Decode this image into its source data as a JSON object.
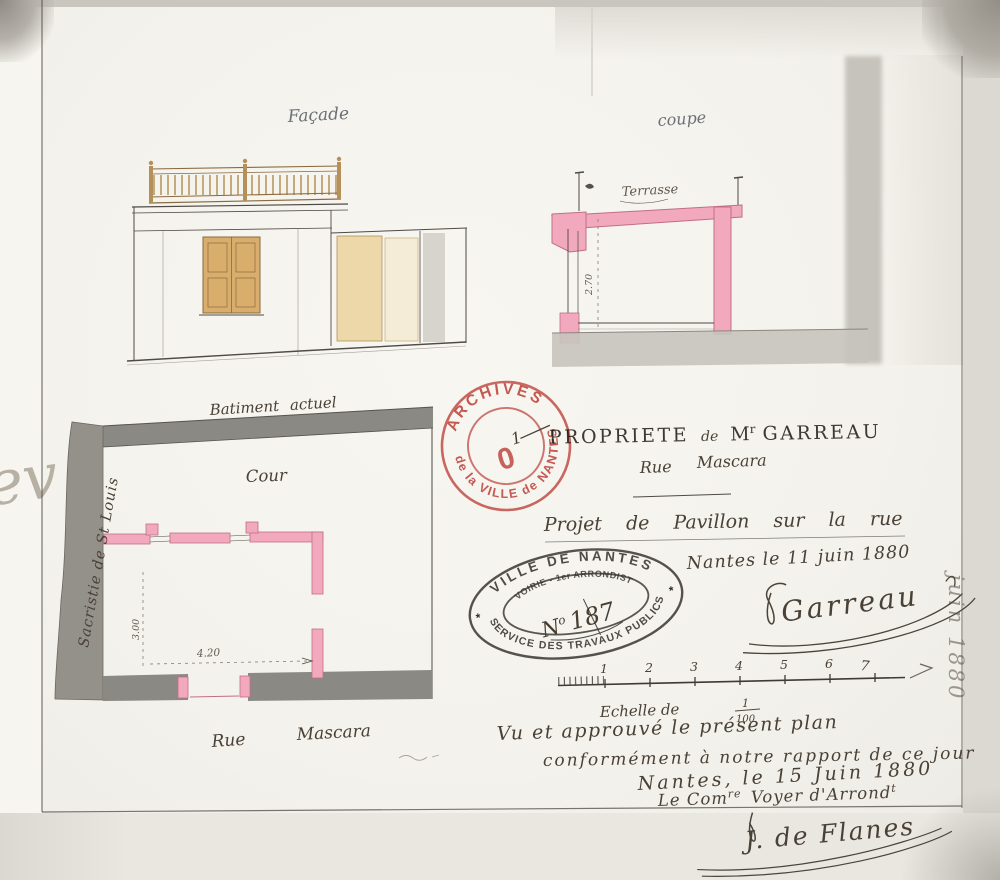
{
  "sheet": {
    "facade_label": "Façade",
    "coupe_label": "coupe",
    "terrasse_label": "Terrasse",
    "coupe_height_dim": "2.70",
    "plan": {
      "batiment_actuel": "Batiment actuel",
      "cour": "Cour",
      "sacristie": "Sacristie de St Louis",
      "rue_word": "Rue",
      "street_name": "Mascara",
      "width_dim": "4.20",
      "depth_dim": "3.00"
    }
  },
  "title_block": {
    "propriete": "PROPRIETE",
    "de": "de",
    "monsieur": "M",
    "monsieur_sup": "r",
    "owner": "GARREAU",
    "rue": "Rue",
    "rue_name": "Mascara",
    "projet_line": "Projet de Pavillon sur la rue",
    "date_line": "Nantes le 11 juin 1880",
    "signature": "Garreau"
  },
  "stamps": {
    "archives": {
      "arc_top": "ARCHIVES",
      "arc_bottom": "de la VILLE de NANTES",
      "center_digit": "0",
      "center_sup": "1",
      "color": "#c2403a"
    },
    "ville": {
      "arc_top": "VILLE DE NANTES",
      "arc_inner": "VOIRIE - 1er ARRONDIST",
      "number_n": "N",
      "number_sup": "o",
      "number_rest": "187",
      "arc_bottom": "SERVICE DES TRAVAUX PUBLICS",
      "star": "*"
    }
  },
  "scale": {
    "numbers": [
      "1",
      "2",
      "3",
      "4",
      "5",
      "6",
      "7"
    ],
    "echelle_label": "Echelle de",
    "fraction_numerator": "1",
    "fraction_denominator": "100"
  },
  "approval": {
    "line1": "Vu et approuvé le présent plan",
    "line2": "conformément à notre rapport de ce jour",
    "line3": "Nantes, le 15 Juin 1880",
    "line4_p1": "Le Com",
    "line4_sup1": "re",
    "line4_p2": " Voyer d'Arrond",
    "line4_sup2": "t",
    "signature": "J. de Flanes"
  },
  "margin_notes": {
    "right_note": "juin 1880",
    "left_mark": "ev"
  },
  "colors": {
    "wash_pink": "#f2a9bd",
    "wash_gray": "#8b8984",
    "wash_tan": "#ecd8a8",
    "stamp_red": "#c2403a",
    "ink": "#3f3a33"
  }
}
